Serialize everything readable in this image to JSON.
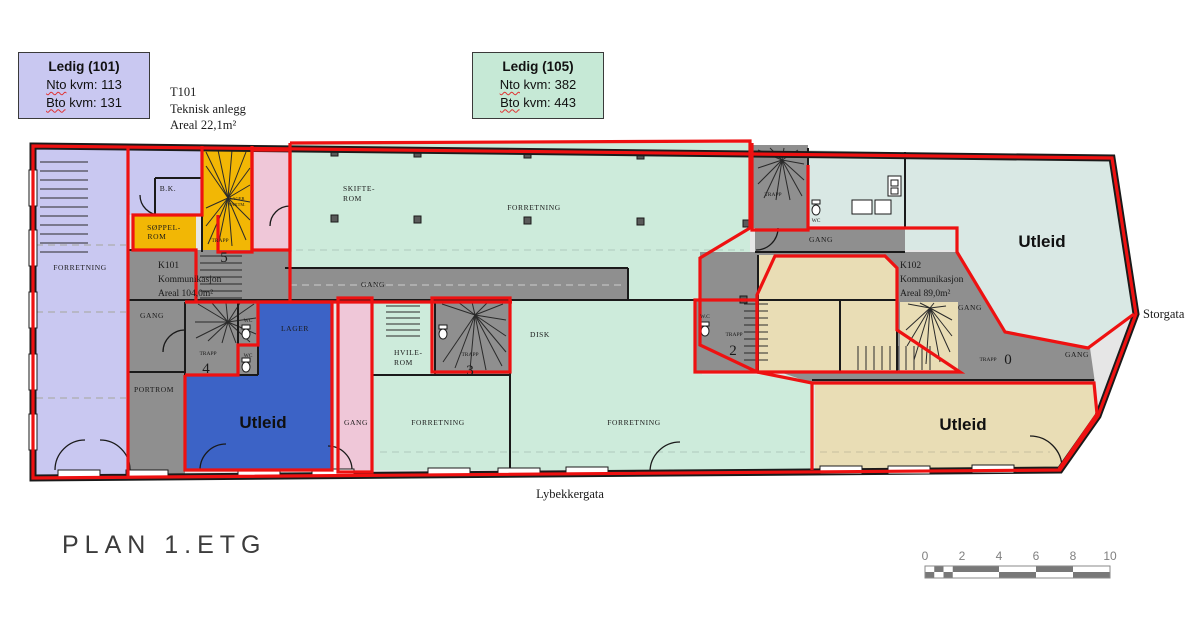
{
  "legend101": {
    "title": "Ledig (101)",
    "nto_word": "Nto",
    "nto_rest": " kvm: 113",
    "bto_word": "Bto",
    "bto_rest": " kvm: 131"
  },
  "legend105": {
    "title": "Ledig (105)",
    "nto_word": "Nto",
    "nto_rest": " kvm: 382",
    "bto_word": "Bto",
    "bto_rest": " kvm: 443"
  },
  "t101": {
    "id": "T101",
    "name": "Teknisk anlegg",
    "area": "Areal 22,1m²"
  },
  "title": "PLAN 1.ETG",
  "streets": {
    "south": "Lybekkergata",
    "east": "Storgata"
  },
  "scalebar": {
    "ticks": [
      "0",
      "2",
      "4",
      "6",
      "8",
      "10"
    ]
  },
  "labels": {
    "forretning": "FORRETNING",
    "gang": "GANG",
    "trapp": "TRAPP",
    "portrom": "PORTROM",
    "bk": "B.K.",
    "soppel_l1": "SØPPEL-",
    "soppel_l2": "ROM",
    "skifte_l1": "SKIFTE-",
    "skifte_l2": "ROM",
    "hvile_l1": "HVILE-",
    "hvile_l2": "ROM",
    "lager": "LAGER",
    "vaktm_l1": "LAGER",
    "vaktm_l2": "VAKTM.",
    "disk": "DISK",
    "wc": "WC",
    "wc_dot": "W.C",
    "utleid": "Utleid",
    "k101": {
      "id": "K101",
      "name": "Kommunikasjon",
      "area": "Areal 104,0m²"
    },
    "k102": {
      "id": "K102",
      "name": "Kommunikasjon",
      "area": "Areal 89,0m²"
    },
    "trapp_nums": {
      "t5": "5",
      "t4": "4",
      "t3": "3",
      "t2": "2",
      "t0": "0"
    }
  },
  "colors": {
    "ledig101": "#c9c8f1",
    "ledig105": "#cdebdb",
    "utleid_blue": "#3c63c6",
    "utleid_cyan": "#d9e8e4",
    "utleid_tan": "#e9ddb5",
    "teknisk_yellow": "#f2b705",
    "gang_pink": "#efc7d8",
    "corridor_gray": "#8f8f8f",
    "lease_outline_red": "#ee1111"
  }
}
